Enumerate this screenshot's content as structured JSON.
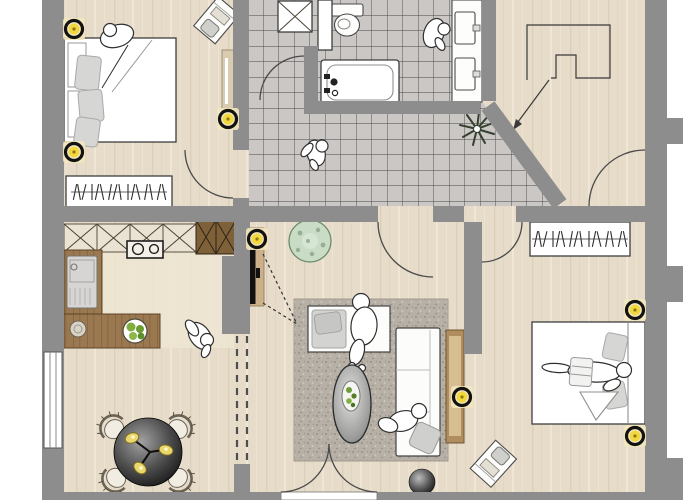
{
  "title": "apartment-floor-plan",
  "colors": {
    "wall": "#8d8d8d",
    "floor": "#e6dcc9",
    "floor_light": "#ede5d4",
    "grain_dark": "#d7cab3",
    "grain_light": "#f1e9da",
    "tile": "#cac7c5",
    "grout": "#474747",
    "fixture": "#ffffff",
    "counter_wood": "#9a7850",
    "counter_grain": "#7c5c38",
    "cabinet_light": "#eae2d3",
    "cabinet_dark": "#7e6138",
    "rug": "#b6b0a6",
    "rug_speck": "#93876f",
    "sofa": "#fcfcfb",
    "cushion": "#d3d3d1",
    "accent_yellow": "#f2d73e",
    "halo": "#f3e7bd",
    "plant": "#c9dcc6",
    "plant_dark": "#8aa487",
    "sideboard": "#b08d5f",
    "table_dark": "#1c1c1c"
  },
  "rooms": [
    {
      "name": "bedroom-top-left",
      "furniture": [
        "double-bed",
        "gray-duvet-pillows",
        "sleeping-person",
        "desk-with-chair",
        "dresser",
        "wardrobe-with-hangers"
      ],
      "lights": 3
    },
    {
      "name": "bathroom",
      "furniture": [
        "shower-washer-unit",
        "toilet",
        "bathtub",
        "double-vanity-sinks",
        "person-at-sink",
        "corner-plant",
        "door-arc"
      ]
    },
    {
      "name": "tiled-corridor",
      "furniture": [
        "walking-person"
      ]
    },
    {
      "name": "entry-hall",
      "furniture": [
        "built-in-outline",
        "entry-direction-arrow",
        "entrance-door-arc"
      ]
    },
    {
      "name": "kitchen-dining",
      "furniture": [
        "upper-cabinets-x",
        "tall-cabinet-x",
        "stove-two-burners",
        "sink-with-drainer",
        "l-shaped-counter",
        "fruit-bowl",
        "small-bowl",
        "standing-person",
        "round-dining-table",
        "four-wicker-chairs",
        "window"
      ]
    },
    {
      "name": "living-room",
      "furniture": [
        "tv-on-wall",
        "tv-view-dashes",
        "round-plant",
        "speckled-rug",
        "bench-with-cushion",
        "sitting-person",
        "oval-coffee-table",
        "snack-plate",
        "sofa",
        "floor-sitting-person",
        "gray-pillow",
        "sphere-pouf",
        "french-doors",
        "sideboard-with-lamp",
        "passage-dashes"
      ]
    },
    {
      "name": "bedroom-bottom-right",
      "furniture": [
        "wardrobe-with-hangers",
        "double-bed",
        "lying-person",
        "folded-blanket",
        "desk-with-chair"
      ],
      "lights": 2
    }
  ],
  "symbols": {
    "ceiling_light_count": 7,
    "door_arc_count": 7,
    "person_count": 7,
    "window_count": 1
  }
}
